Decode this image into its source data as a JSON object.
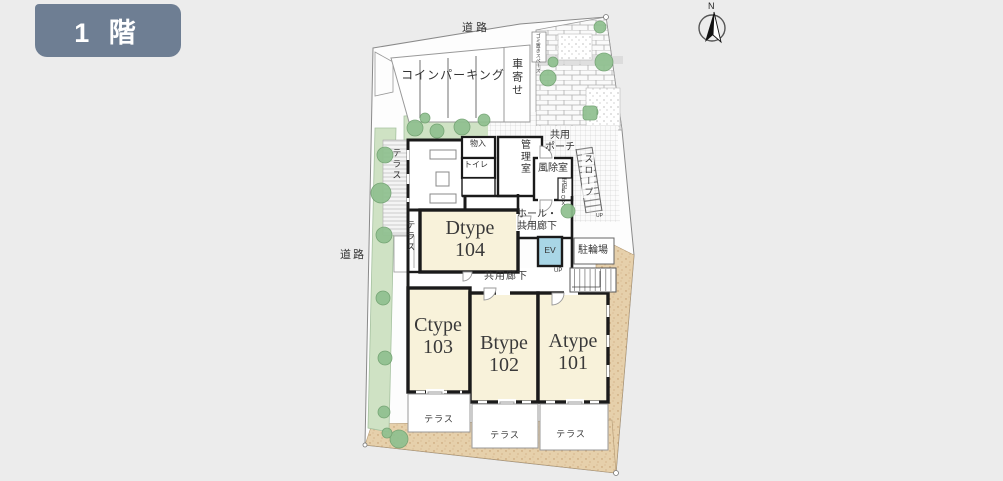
{
  "floor_badge": {
    "label": "1 階"
  },
  "compass": {
    "north_label": "N"
  },
  "roads": {
    "top": "道路",
    "left": "道路"
  },
  "site": {
    "coin_parking": "コインパーキング",
    "carriage_porch": "車寄せ",
    "garbage_space": "ゴミ置きスペース",
    "bicycle_parking": "駐輪場",
    "slope": "スロープ",
    "stairs_up": "UP",
    "terrace": "テラス"
  },
  "common_areas": {
    "common_porch_line1": "共用",
    "common_porch_line2": "ポーチ",
    "manager_room": "管理室",
    "storage": "物入",
    "toilet": "トイレ",
    "windbreak_room": "風除室",
    "delivery_box": "宅配BOX",
    "hall_line1": "ホール・",
    "hall_line2": "共用廊下",
    "elevator": "EV",
    "common_corridor": "共用廊下"
  },
  "units": [
    {
      "type": "Dtype",
      "number": "104"
    },
    {
      "type": "Ctype",
      "number": "103"
    },
    {
      "type": "Btype",
      "number": "102"
    },
    {
      "type": "Atype",
      "number": "101"
    }
  ],
  "colors": {
    "background": "#ECECEC",
    "badge_bg": "#6E7E93",
    "room_fill": "#F8F2DA",
    "elevator_fill": "#A9D6E6",
    "greenery": "#CFE2C4",
    "tree": "#8FC08F",
    "sand": "#E6D0AB",
    "wall": "#1A1A1A"
  }
}
